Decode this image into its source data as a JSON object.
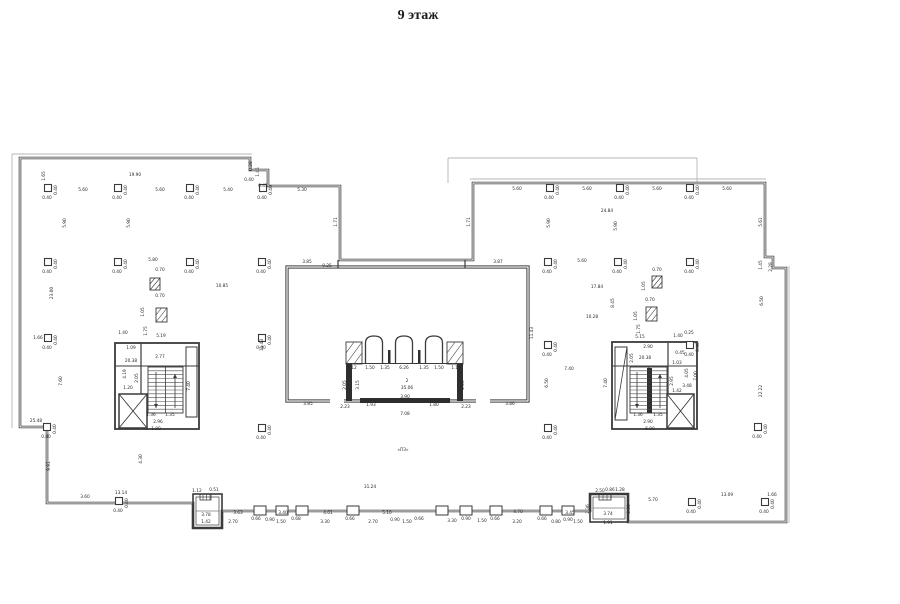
{
  "title": "9 этаж",
  "colors": {
    "wall": "#3a3a3a",
    "thin_line": "#b5b5b5",
    "label": "#2a2a2a",
    "fill_dark": "#2e2e2e",
    "background": "#ffffff"
  },
  "floor_plan": {
    "canvas": {
      "w": 900,
      "h": 604
    },
    "column_dim": "0.40",
    "outline_path": "M 20 158 L 250 158 L 250 170 L 268 170 L 268 186 L 340 186 L 340 260 L 473 260 L 473 183 L 765 183 L 765 257 L 773 257 L 773 268 L 786 268 L 786 522 L 628 522 L 628 494 L 590 494 L 590 511 L 222 511 L 222 528 L 193 528 L 193 503 L 47 503 L 47 427 L 20 427 Z",
    "core_rect": [
      287,
      267,
      241,
      134
    ],
    "thin_lines": [
      [
        448,
        183,
        448,
        158
      ],
      [
        448,
        158,
        697,
        158
      ],
      [
        697,
        158,
        697,
        183
      ],
      [
        12,
        154,
        252,
        154
      ],
      [
        12,
        154,
        12,
        428
      ],
      [
        470,
        179,
        766,
        179
      ],
      [
        789,
        266,
        789,
        523
      ]
    ],
    "lines": [
      [
        141,
        343,
        141,
        394,
        1.2
      ],
      [
        668,
        343,
        668,
        394,
        1.2
      ],
      [
        115,
        366,
        199,
        366,
        0.9
      ],
      [
        612,
        366,
        697,
        366,
        0.9
      ],
      [
        615,
        420,
        627,
        347,
        0.8
      ],
      [
        338,
        260,
        338,
        268,
        1.2
      ],
      [
        465,
        260,
        465,
        268,
        1.2
      ],
      [
        346,
        363.5,
        463,
        363.5,
        0.9
      ],
      [
        203,
        494,
        203,
        500,
        0.6
      ],
      [
        206.5,
        494,
        206.5,
        500,
        0.6
      ],
      [
        210,
        494,
        210,
        500,
        0.6
      ],
      [
        603,
        494,
        603,
        500,
        0.6
      ],
      [
        607,
        494,
        607,
        500,
        0.6
      ],
      [
        611,
        494,
        611,
        500,
        0.6
      ],
      [
        196,
        511,
        219,
        511,
        0.6
      ],
      [
        593,
        508,
        625,
        508,
        0.6
      ]
    ],
    "rects": [
      [
        115,
        343,
        84,
        86,
        1.8
      ],
      [
        612,
        342,
        85,
        87,
        1.8
      ],
      [
        186,
        347,
        11,
        70,
        1
      ],
      [
        615,
        347,
        12,
        73,
        1
      ],
      [
        193,
        494,
        29,
        34,
        1.6
      ],
      [
        590,
        494,
        38,
        28,
        1.6
      ],
      [
        196,
        497,
        23,
        28,
        0.7
      ],
      [
        593,
        497,
        32,
        22,
        0.7
      ],
      [
        200,
        494,
        11,
        6,
        0.8
      ],
      [
        599,
        494,
        12,
        6,
        0.8
      ]
    ],
    "gaps": [
      [
        330,
        397,
        14,
        7
      ],
      [
        476,
        397,
        14,
        7
      ]
    ],
    "filled": [
      [
        346,
        363,
        6,
        38
      ],
      [
        457,
        363,
        6,
        38
      ],
      [
        360,
        398,
        90,
        5
      ],
      [
        647,
        368,
        5,
        45
      ],
      [
        388,
        350,
        2.5,
        13
      ],
      [
        418,
        350,
        2.5,
        13
      ]
    ],
    "hatches": [
      [
        346,
        342,
        16,
        22
      ],
      [
        447,
        342,
        16,
        22
      ],
      [
        150,
        278,
        10,
        12
      ],
      [
        156,
        308,
        11,
        14
      ],
      [
        652,
        276,
        10,
        12
      ],
      [
        646,
        307,
        11,
        14
      ]
    ],
    "xboxes": [
      [
        119,
        394,
        28,
        34
      ],
      [
        667,
        394,
        27,
        34
      ]
    ],
    "lifts": {
      "cx": [
        374,
        404,
        434
      ],
      "top": 336,
      "bottom": 363,
      "halfw": 8.5
    },
    "treads": [
      {
        "x": 148,
        "y": 367,
        "w": 35,
        "h": 46,
        "n": 12,
        "cx": 165.5
      },
      {
        "x": 630,
        "y": 367,
        "w": 37,
        "h": 46,
        "n": 12,
        "cx": 649
      }
    ],
    "arrows": [
      [
        156,
        372,
        408
      ],
      [
        175,
        408,
        374
      ],
      [
        637,
        372,
        408
      ],
      [
        660,
        408,
        374
      ]
    ],
    "columns": [
      [
        48,
        188
      ],
      [
        118,
        188
      ],
      [
        190,
        188
      ],
      [
        263,
        188
      ],
      [
        48,
        262
      ],
      [
        118,
        262
      ],
      [
        190,
        262
      ],
      [
        262,
        262
      ],
      [
        48,
        338
      ],
      [
        262,
        338
      ],
      [
        47,
        427
      ],
      [
        262,
        428
      ],
      [
        119,
        501
      ],
      [
        550,
        188
      ],
      [
        620,
        188
      ],
      [
        690,
        188
      ],
      [
        548,
        262
      ],
      [
        618,
        262
      ],
      [
        690,
        262
      ],
      [
        548,
        345
      ],
      [
        690,
        345
      ],
      [
        548,
        428
      ],
      [
        758,
        427
      ],
      [
        692,
        502
      ],
      [
        765,
        502
      ]
    ],
    "pilasters": [
      260,
      282,
      302,
      353,
      442,
      466,
      496,
      546,
      568
    ],
    "labels": [
      [
        45,
        176,
        "1.65",
        1
      ],
      [
        135,
        176,
        "19.90"
      ],
      [
        83,
        191,
        "5.60"
      ],
      [
        160,
        191,
        "5.60"
      ],
      [
        228,
        191,
        "5.40"
      ],
      [
        66,
        223,
        "5.90",
        1
      ],
      [
        130,
        223,
        "5.90",
        1
      ],
      [
        53,
        293,
        "23.00",
        1
      ],
      [
        153,
        261,
        "5.80"
      ],
      [
        160,
        271,
        "0.70"
      ],
      [
        222,
        287,
        "10.85"
      ],
      [
        160,
        297,
        "0.70"
      ],
      [
        144,
        312,
        "1.05",
        1
      ],
      [
        147,
        331,
        "1.75",
        1
      ],
      [
        38,
        339,
        "1.66"
      ],
      [
        62,
        381,
        "7.60",
        1
      ],
      [
        263,
        345,
        "11.43",
        1
      ],
      [
        36,
        422,
        "25.48"
      ],
      [
        50,
        466,
        "9.91",
        1
      ],
      [
        85,
        498,
        "3.60"
      ],
      [
        121,
        494,
        "13.14"
      ],
      [
        142,
        459,
        "4.30",
        1
      ],
      [
        252,
        166,
        "0.28",
        1
      ],
      [
        259,
        172,
        "1.45",
        1
      ],
      [
        249,
        181,
        "0.40"
      ],
      [
        263,
        187,
        "0.43"
      ],
      [
        302,
        191,
        "5.30"
      ],
      [
        337,
        222,
        "1.71",
        1
      ],
      [
        307,
        263,
        "3.85"
      ],
      [
        327,
        267,
        "0.25"
      ],
      [
        498,
        263,
        "3.87"
      ],
      [
        470,
        222,
        "1.71",
        1
      ],
      [
        123,
        334,
        "1.40"
      ],
      [
        161,
        337,
        "5.19"
      ],
      [
        131,
        349,
        "1.09"
      ],
      [
        131,
        362,
        "20.38"
      ],
      [
        160,
        358,
        "2.77"
      ],
      [
        126,
        374,
        "4.19",
        1
      ],
      [
        138,
        378,
        "2.05",
        1
      ],
      [
        128,
        389,
        "1.20"
      ],
      [
        190,
        386,
        "7.40",
        1
      ],
      [
        151,
        416,
        "1.36"
      ],
      [
        170,
        416,
        "1.35"
      ],
      [
        158,
        423,
        "2.96"
      ],
      [
        156,
        430,
        "1.80"
      ],
      [
        352,
        369,
        "1.12"
      ],
      [
        370,
        369,
        "1.50"
      ],
      [
        385,
        369,
        "1.35"
      ],
      [
        404,
        369,
        "6.26"
      ],
      [
        424,
        369,
        "1.35"
      ],
      [
        439,
        369,
        "1.50"
      ],
      [
        456,
        369,
        "1.12"
      ],
      [
        359,
        385,
        "3.15",
        1
      ],
      [
        346,
        385,
        "2.05",
        1
      ],
      [
        464,
        385,
        "2.05",
        1
      ],
      [
        407,
        382,
        "2"
      ],
      [
        407,
        389,
        "35.06"
      ],
      [
        405,
        398,
        "3.90"
      ],
      [
        308,
        405,
        "3.85"
      ],
      [
        345,
        408,
        "2.23"
      ],
      [
        371,
        406,
        "1.93"
      ],
      [
        434,
        406,
        "1.80"
      ],
      [
        466,
        408,
        "2.23"
      ],
      [
        510,
        405,
        "3.86"
      ],
      [
        405,
        415,
        "7.08"
      ],
      [
        403,
        451,
        "«ПЗ»"
      ],
      [
        517,
        190,
        "5.60"
      ],
      [
        587,
        190,
        "5.60"
      ],
      [
        657,
        190,
        "5.60"
      ],
      [
        727,
        190,
        "5.60"
      ],
      [
        607,
        212,
        "24.84"
      ],
      [
        550,
        223,
        "5.90",
        1
      ],
      [
        617,
        226,
        "5.90",
        1
      ],
      [
        762,
        222,
        "5.61",
        1
      ],
      [
        582,
        262,
        "5.60"
      ],
      [
        597,
        288,
        "17.84"
      ],
      [
        592,
        318,
        "10.28"
      ],
      [
        614,
        303,
        "8.45",
        1
      ],
      [
        657,
        271,
        "0.70"
      ],
      [
        645,
        286,
        "1.05",
        1
      ],
      [
        650,
        301,
        "0.70"
      ],
      [
        637,
        316,
        "1.05",
        1
      ],
      [
        640,
        329,
        "1.75",
        1
      ],
      [
        533,
        333,
        "11.43",
        1
      ],
      [
        763,
        301,
        "6.50",
        1
      ],
      [
        569,
        370,
        "7.40"
      ],
      [
        548,
        383,
        "6.50",
        1
      ],
      [
        762,
        391,
        "22.22",
        1
      ],
      [
        762,
        265,
        "1.45",
        1
      ],
      [
        772,
        267,
        "2.28",
        1
      ],
      [
        640,
        338,
        "5.15"
      ],
      [
        678,
        337,
        "1.40"
      ],
      [
        689,
        334,
        "0.25"
      ],
      [
        648,
        348,
        "2.90"
      ],
      [
        633,
        358,
        "2.05",
        1
      ],
      [
        645,
        359,
        "20.38"
      ],
      [
        680,
        354,
        "0.45"
      ],
      [
        677,
        364,
        "1.03"
      ],
      [
        688,
        373,
        "4.05",
        1
      ],
      [
        697,
        376,
        "7.00",
        1
      ],
      [
        607,
        383,
        "7.40",
        1
      ],
      [
        673,
        381,
        "2.95",
        1
      ],
      [
        687,
        387,
        "3.48"
      ],
      [
        677,
        392,
        "1.42"
      ],
      [
        638,
        416,
        "1.36"
      ],
      [
        658,
        416,
        "1.35"
      ],
      [
        648,
        423,
        "2.90"
      ],
      [
        650,
        430,
        "6.90"
      ],
      [
        370,
        488,
        "31.24"
      ],
      [
        238,
        514,
        "3.63"
      ],
      [
        283,
        514,
        "3.40"
      ],
      [
        328,
        514,
        "4.01"
      ],
      [
        387,
        514,
        "5.10"
      ],
      [
        518,
        513,
        "4.70"
      ],
      [
        570,
        514,
        "3.45"
      ],
      [
        233,
        523,
        "2.70"
      ],
      [
        256,
        520,
        "0.66"
      ],
      [
        270,
        521,
        "0.90"
      ],
      [
        281,
        523,
        "1.50"
      ],
      [
        296,
        520,
        "0.68"
      ],
      [
        325,
        523,
        "3.30"
      ],
      [
        350,
        520,
        "0.66"
      ],
      [
        373,
        523,
        "2.70"
      ],
      [
        395,
        521,
        "0.90"
      ],
      [
        407,
        523,
        "1.50"
      ],
      [
        419,
        520,
        "0.66"
      ],
      [
        452,
        522,
        "3.30"
      ],
      [
        466,
        520,
        "0.90"
      ],
      [
        482,
        522,
        "1.50"
      ],
      [
        495,
        520,
        "0.66"
      ],
      [
        517,
        523,
        "3.20"
      ],
      [
        542,
        520,
        "0.66"
      ],
      [
        556,
        523,
        "0.80"
      ],
      [
        568,
        521,
        "0.90"
      ],
      [
        578,
        523,
        "1.50"
      ],
      [
        653,
        501,
        "5.70"
      ],
      [
        727,
        496,
        "13.09"
      ],
      [
        772,
        496,
        "1.66"
      ],
      [
        197,
        492,
        "1.12"
      ],
      [
        214,
        491,
        "0.51"
      ],
      [
        206,
        516,
        "3.78"
      ],
      [
        206,
        523,
        "1.42"
      ],
      [
        600,
        492,
        "2.50"
      ],
      [
        610,
        491,
        "0.86"
      ],
      [
        620,
        491,
        "1.28"
      ],
      [
        608,
        515,
        "3.74"
      ],
      [
        608,
        524,
        "1.91"
      ],
      [
        589,
        509,
        "2.36",
        1
      ],
      [
        630,
        509,
        "0.36",
        1
      ]
    ]
  }
}
